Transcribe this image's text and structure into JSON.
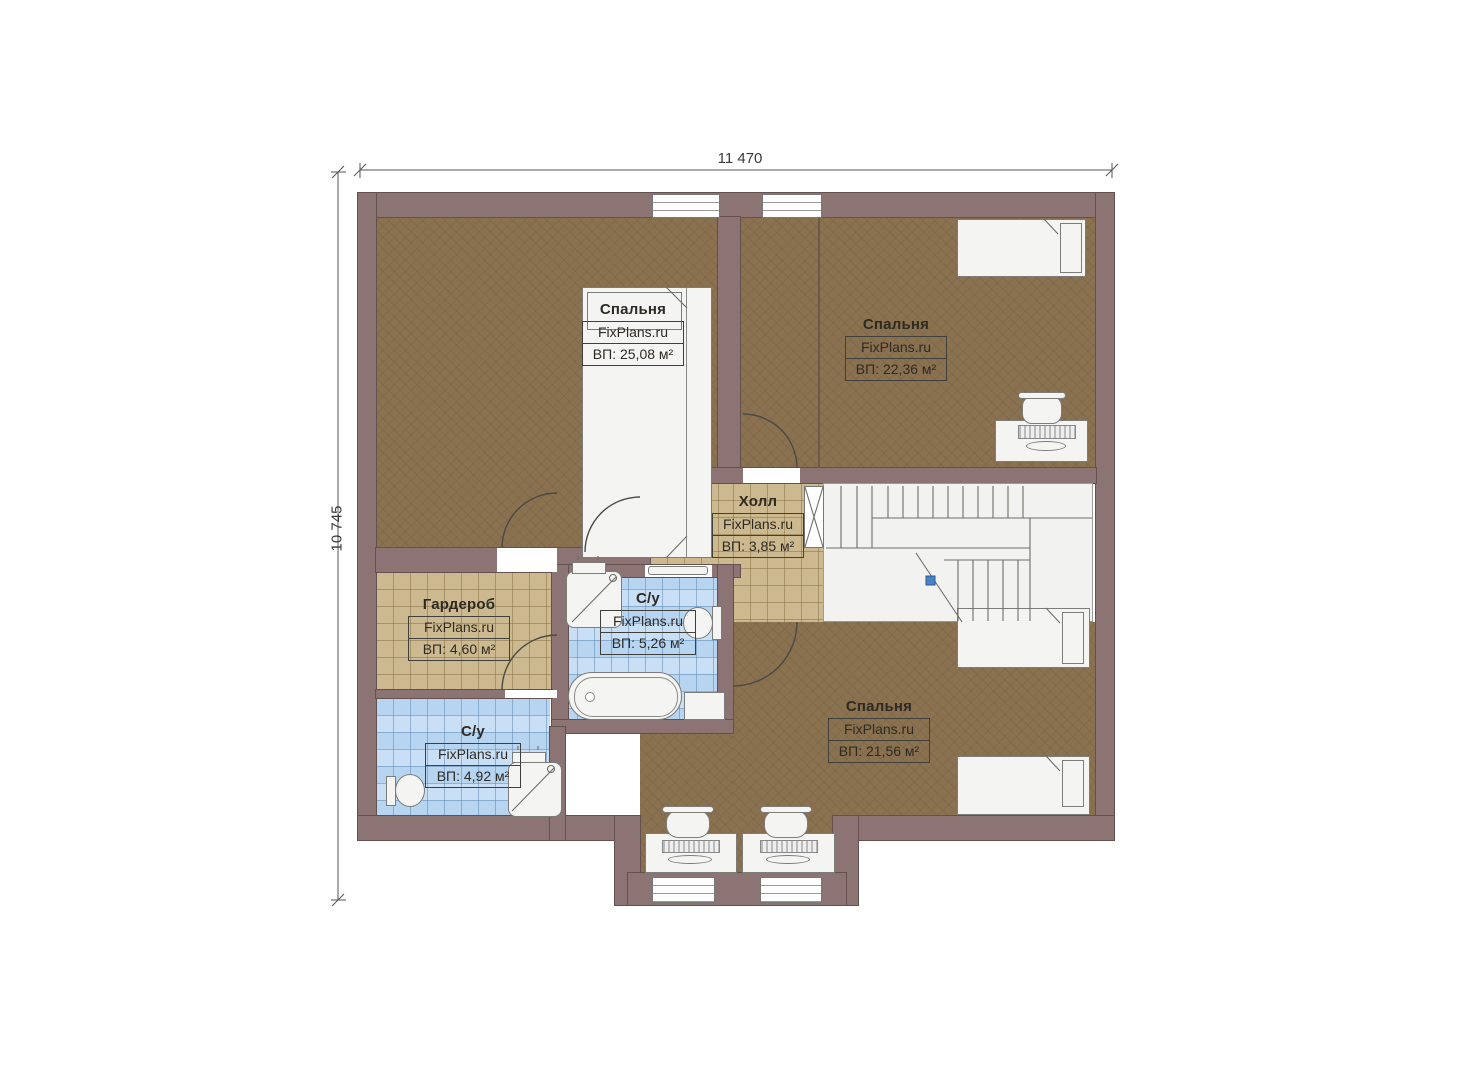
{
  "title": "Floor plan (second floor)",
  "watermark": "FixPlans.ru",
  "dimensions": {
    "width_label": "11 470",
    "height_label": "10 745"
  },
  "rooms": [
    {
      "id": "bedroom-1",
      "name": "Спальня",
      "area": "ВП: 25,08 м²"
    },
    {
      "id": "bedroom-2",
      "name": "Спальня",
      "area": "ВП: 22,36 м²"
    },
    {
      "id": "hall",
      "name": "Холл",
      "area": "ВП: 3,85 м²"
    },
    {
      "id": "wardrobe",
      "name": "Гардероб",
      "area": "ВП: 4,60 м²"
    },
    {
      "id": "bathroom-1",
      "name": "С/у",
      "area": "ВП: 5,26 м²"
    },
    {
      "id": "bathroom-2",
      "name": "С/у",
      "area": "ВП: 4,92 м²"
    },
    {
      "id": "bedroom-3",
      "name": "Спальня",
      "area": "ВП: 21,56 м²"
    }
  ],
  "colors": {
    "wall": "#8c7474",
    "bedroom_floor": "#8a7150",
    "hall_floor": "#cdb98f",
    "bathroom_floor": "#b7d4f1",
    "stair_marker_blue": "#4a7fc1"
  }
}
